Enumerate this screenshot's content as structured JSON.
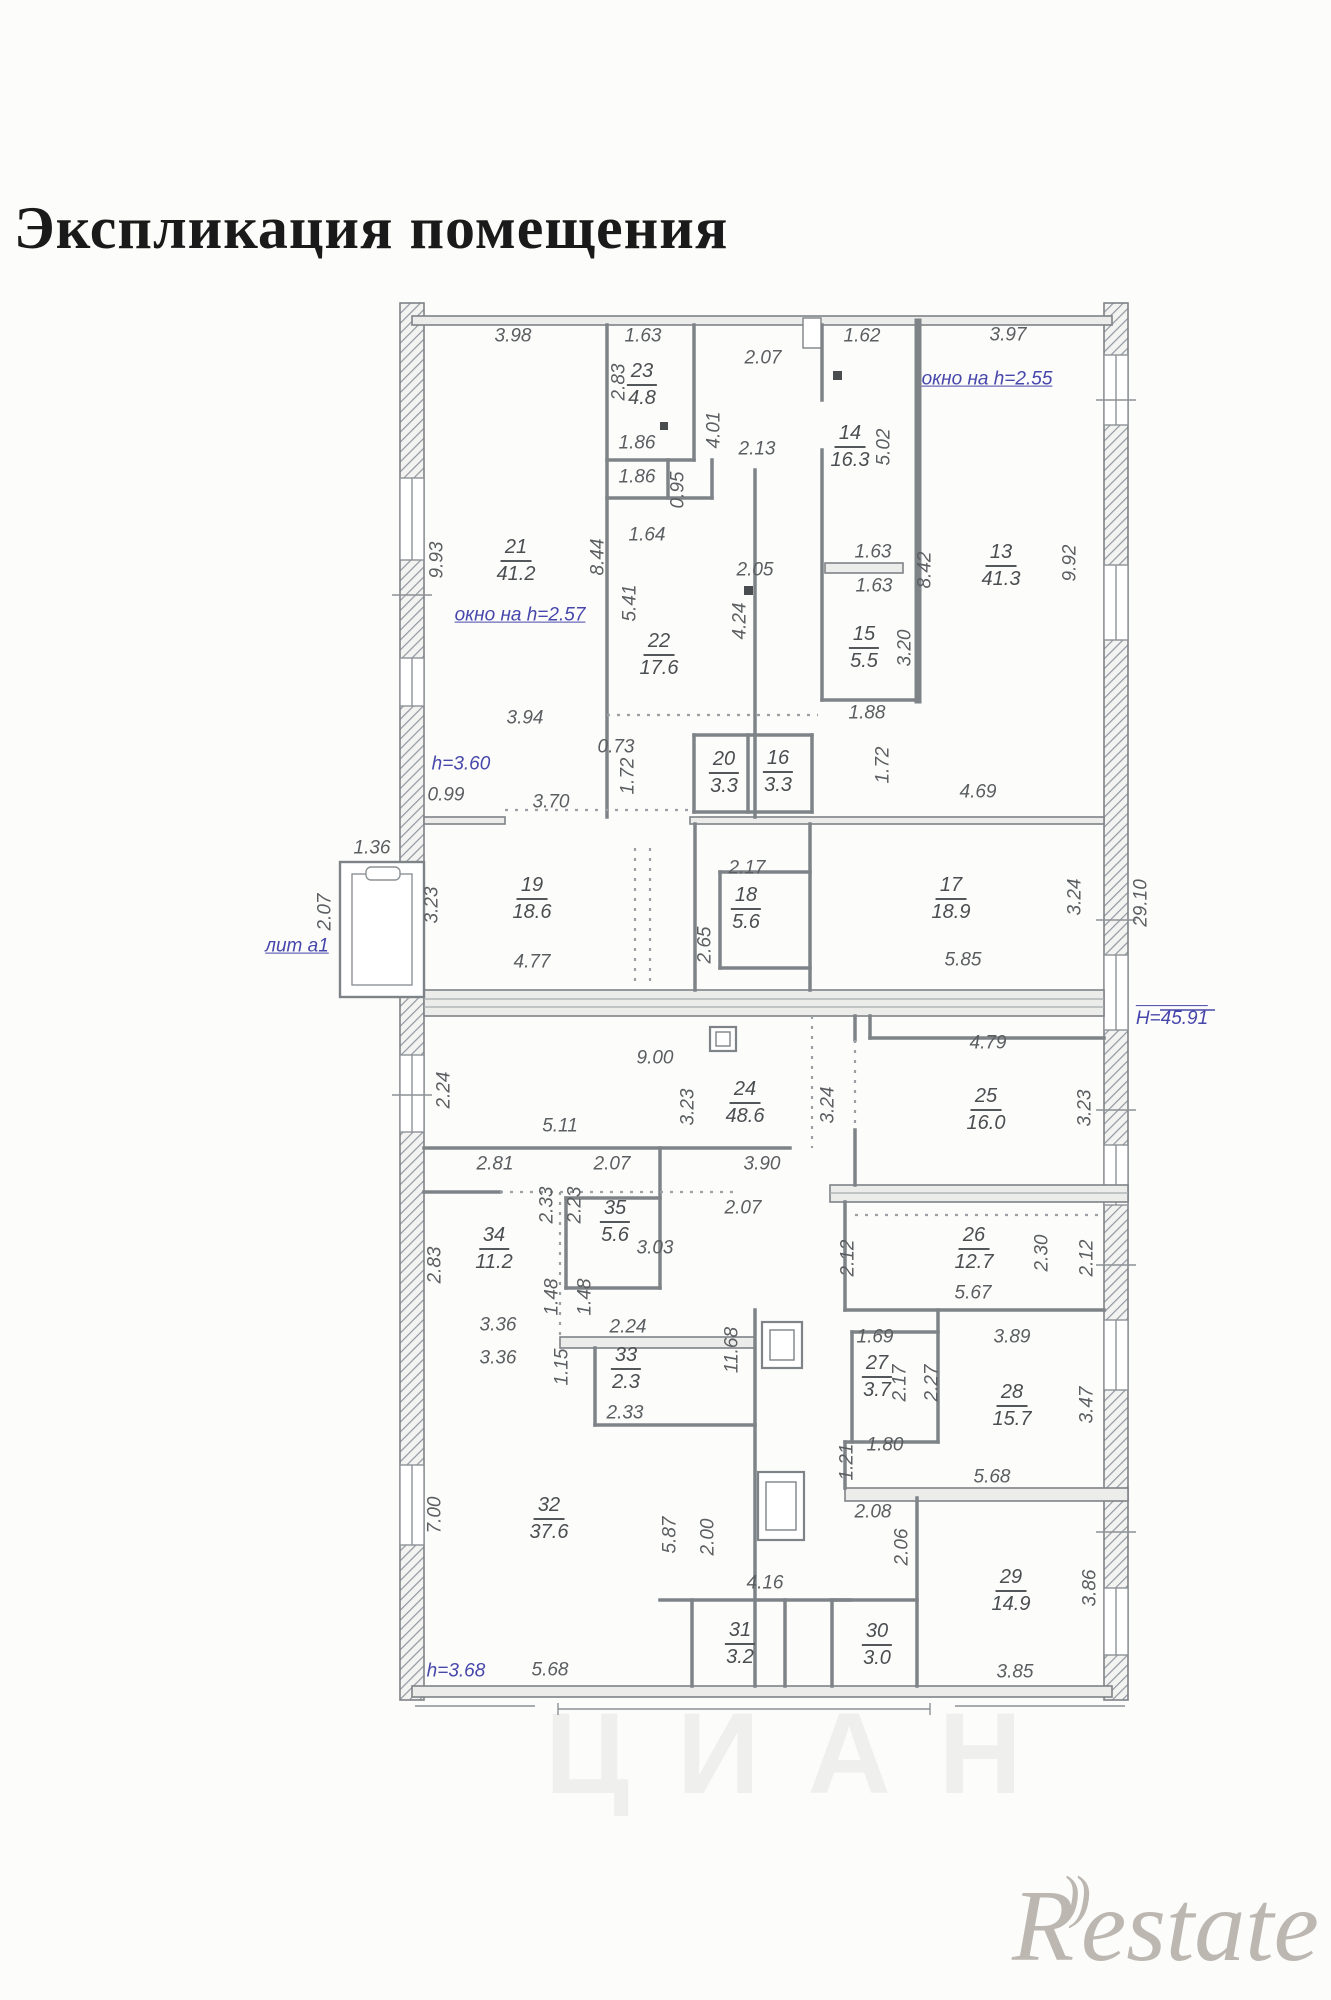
{
  "title": "Экспликация помещения",
  "watermarks": {
    "center": "ЦИАН",
    "logo_r": "R",
    "logo_arcs": "))",
    "logo_rest": "estate"
  },
  "plan": {
    "colors": {
      "wall": "#7e8387",
      "text": "#5b5e61",
      "note": "#4747ab"
    },
    "rooms": [
      {
        "n": "23",
        "a": "4.8",
        "x": 642,
        "y": 385
      },
      {
        "n": "14",
        "a": "16.3",
        "x": 850,
        "y": 447
      },
      {
        "n": "21",
        "a": "41.2",
        "x": 516,
        "y": 561
      },
      {
        "n": "13",
        "a": "41.3",
        "x": 1001,
        "y": 566
      },
      {
        "n": "22",
        "a": "17.6",
        "x": 659,
        "y": 655
      },
      {
        "n": "15",
        "a": "5.5",
        "x": 864,
        "y": 648
      },
      {
        "n": "20",
        "a": "3.3",
        "x": 724,
        "y": 773
      },
      {
        "n": "16",
        "a": "3.3",
        "x": 778,
        "y": 772
      },
      {
        "n": "19",
        "a": "18.6",
        "x": 532,
        "y": 899
      },
      {
        "n": "18",
        "a": "5.6",
        "x": 746,
        "y": 909
      },
      {
        "n": "17",
        "a": "18.9",
        "x": 951,
        "y": 899
      },
      {
        "n": "24",
        "a": "48.6",
        "x": 745,
        "y": 1103
      },
      {
        "n": "25",
        "a": "16.0",
        "x": 986,
        "y": 1110
      },
      {
        "n": "35",
        "a": "5.6",
        "x": 615,
        "y": 1222
      },
      {
        "n": "34",
        "a": "11.2",
        "x": 494,
        "y": 1249
      },
      {
        "n": "26",
        "a": "12.7",
        "x": 974,
        "y": 1249
      },
      {
        "n": "33",
        "a": "2.3",
        "x": 626,
        "y": 1369
      },
      {
        "n": "27",
        "a": "3.7",
        "x": 877,
        "y": 1377
      },
      {
        "n": "28",
        "a": "15.7",
        "x": 1012,
        "y": 1406
      },
      {
        "n": "32",
        "a": "37.6",
        "x": 549,
        "y": 1519
      },
      {
        "n": "31",
        "a": "3.2",
        "x": 740,
        "y": 1644
      },
      {
        "n": "30",
        "a": "3.0",
        "x": 877,
        "y": 1645
      },
      {
        "n": "29",
        "a": "14.9",
        "x": 1011,
        "y": 1591
      }
    ],
    "dims": [
      {
        "t": "3.98",
        "x": 513,
        "y": 336
      },
      {
        "t": "1.63",
        "x": 643,
        "y": 336
      },
      {
        "t": "2.07",
        "x": 763,
        "y": 358
      },
      {
        "t": "1.62",
        "x": 862,
        "y": 336
      },
      {
        "t": "3.97",
        "x": 1008,
        "y": 335
      },
      {
        "t": "2.83",
        "x": 619,
        "y": 382,
        "r": 1
      },
      {
        "t": "1.86",
        "x": 637,
        "y": 443
      },
      {
        "t": "4.01",
        "x": 714,
        "y": 430,
        "r": 1
      },
      {
        "t": "2.13",
        "x": 757,
        "y": 449
      },
      {
        "t": "5.02",
        "x": 884,
        "y": 447,
        "r": 1
      },
      {
        "t": "1.86",
        "x": 637,
        "y": 477
      },
      {
        "t": "0.95",
        "x": 678,
        "y": 490,
        "r": 1
      },
      {
        "t": "1.64",
        "x": 647,
        "y": 535
      },
      {
        "t": "9.93",
        "x": 437,
        "y": 560,
        "r": 1
      },
      {
        "t": "8.44",
        "x": 598,
        "y": 557,
        "r": 1
      },
      {
        "t": "5.41",
        "x": 630,
        "y": 603,
        "r": 1
      },
      {
        "t": "1.63",
        "x": 873,
        "y": 552
      },
      {
        "t": "1.63",
        "x": 874,
        "y": 586
      },
      {
        "t": "8.42",
        "x": 925,
        "y": 570,
        "r": 1
      },
      {
        "t": "9.92",
        "x": 1070,
        "y": 563,
        "r": 1
      },
      {
        "t": "2.05",
        "x": 755,
        "y": 570
      },
      {
        "t": "4.24",
        "x": 740,
        "y": 621,
        "r": 1
      },
      {
        "t": "3.20",
        "x": 905,
        "y": 648,
        "r": 1
      },
      {
        "t": "3.94",
        "x": 525,
        "y": 718
      },
      {
        "t": "0.73",
        "x": 616,
        "y": 747
      },
      {
        "t": "1.88",
        "x": 867,
        "y": 713
      },
      {
        "t": "1.72",
        "x": 628,
        "y": 776,
        "r": 1
      },
      {
        "t": "1.72",
        "x": 883,
        "y": 765,
        "r": 1
      },
      {
        "t": "0.99",
        "x": 446,
        "y": 795
      },
      {
        "t": "3.70",
        "x": 551,
        "y": 802
      },
      {
        "t": "4.69",
        "x": 978,
        "y": 792
      },
      {
        "t": "1.36",
        "x": 372,
        "y": 848
      },
      {
        "t": "2.17",
        "x": 747,
        "y": 868
      },
      {
        "t": "2.07",
        "x": 325,
        "y": 912,
        "r": 1
      },
      {
        "t": "3.23",
        "x": 432,
        "y": 905,
        "r": 1
      },
      {
        "t": "2.65",
        "x": 705,
        "y": 945,
        "r": 1
      },
      {
        "t": "3.24",
        "x": 1075,
        "y": 897,
        "r": 1
      },
      {
        "t": "29.10",
        "x": 1141,
        "y": 903,
        "r": 1
      },
      {
        "t": "4.77",
        "x": 532,
        "y": 962
      },
      {
        "t": "5.85",
        "x": 963,
        "y": 960
      },
      {
        "t": "9.00",
        "x": 655,
        "y": 1058
      },
      {
        "t": "2.24",
        "x": 444,
        "y": 1090,
        "r": 1
      },
      {
        "t": "3.23",
        "x": 688,
        "y": 1107,
        "r": 1
      },
      {
        "t": "3.24",
        "x": 828,
        "y": 1105,
        "r": 1
      },
      {
        "t": "4.79",
        "x": 988,
        "y": 1043
      },
      {
        "t": "3.23",
        "x": 1085,
        "y": 1108,
        "r": 1
      },
      {
        "t": "5.11",
        "x": 560,
        "y": 1126
      },
      {
        "t": "2.81",
        "x": 495,
        "y": 1164
      },
      {
        "t": "2.07",
        "x": 612,
        "y": 1164
      },
      {
        "t": "3.90",
        "x": 762,
        "y": 1164
      },
      {
        "t": "2.33",
        "x": 547,
        "y": 1205,
        "r": 1
      },
      {
        "t": "2.23",
        "x": 575,
        "y": 1205,
        "r": 1
      },
      {
        "t": "2.07",
        "x": 743,
        "y": 1208
      },
      {
        "t": "3.03",
        "x": 655,
        "y": 1248
      },
      {
        "t": "2.83",
        "x": 435,
        "y": 1265,
        "r": 1
      },
      {
        "t": "2.30",
        "x": 1042,
        "y": 1253,
        "r": 1
      },
      {
        "t": "2.12",
        "x": 848,
        "y": 1258,
        "r": 1
      },
      {
        "t": "2.12",
        "x": 1087,
        "y": 1258,
        "r": 1
      },
      {
        "t": "5.67",
        "x": 973,
        "y": 1293
      },
      {
        "t": "1.48",
        "x": 552,
        "y": 1297,
        "r": 1
      },
      {
        "t": "1.48",
        "x": 585,
        "y": 1297,
        "r": 1
      },
      {
        "t": "3.36",
        "x": 498,
        "y": 1325
      },
      {
        "t": "2.24",
        "x": 628,
        "y": 1327
      },
      {
        "t": "3.36",
        "x": 498,
        "y": 1358
      },
      {
        "t": "1.15",
        "x": 562,
        "y": 1367,
        "r": 1
      },
      {
        "t": "11.68",
        "x": 732,
        "y": 1350,
        "r": 1
      },
      {
        "t": "2.33",
        "x": 625,
        "y": 1413
      },
      {
        "t": "1.69",
        "x": 875,
        "y": 1337
      },
      {
        "t": "2.17",
        "x": 900,
        "y": 1383,
        "r": 1
      },
      {
        "t": "2.27",
        "x": 932,
        "y": 1383,
        "r": 1
      },
      {
        "t": "3.89",
        "x": 1012,
        "y": 1337
      },
      {
        "t": "3.47",
        "x": 1087,
        "y": 1405,
        "r": 1
      },
      {
        "t": "1.80",
        "x": 885,
        "y": 1445
      },
      {
        "t": "1.21",
        "x": 847,
        "y": 1462,
        "r": 1
      },
      {
        "t": "5.68",
        "x": 992,
        "y": 1477
      },
      {
        "t": "2.08",
        "x": 873,
        "y": 1512
      },
      {
        "t": "2.06",
        "x": 902,
        "y": 1547,
        "r": 1
      },
      {
        "t": "7.00",
        "x": 435,
        "y": 1515,
        "r": 1
      },
      {
        "t": "5.87",
        "x": 670,
        "y": 1535,
        "r": 1
      },
      {
        "t": "2.00",
        "x": 708,
        "y": 1537,
        "r": 1
      },
      {
        "t": "4.16",
        "x": 765,
        "y": 1583
      },
      {
        "t": "3.86",
        "x": 1090,
        "y": 1588,
        "r": 1
      },
      {
        "t": "5.68",
        "x": 550,
        "y": 1670
      },
      {
        "t": "3.85",
        "x": 1015,
        "y": 1672
      }
    ],
    "notes": [
      {
        "t": "окно на h=2.55",
        "x": 987,
        "y": 380,
        "u": 1
      },
      {
        "t": "окно на h=2.57",
        "x": 520,
        "y": 616,
        "u": 1
      },
      {
        "t": "h=3.60",
        "x": 461,
        "y": 765
      },
      {
        "t": "лит а1",
        "x": 297,
        "y": 947,
        "u": 1
      },
      {
        "t": "Н=45.91",
        "x": 1172,
        "y": 1018,
        "o": 1
      },
      {
        "t": "h=3.68",
        "x": 456,
        "y": 1672
      }
    ]
  }
}
